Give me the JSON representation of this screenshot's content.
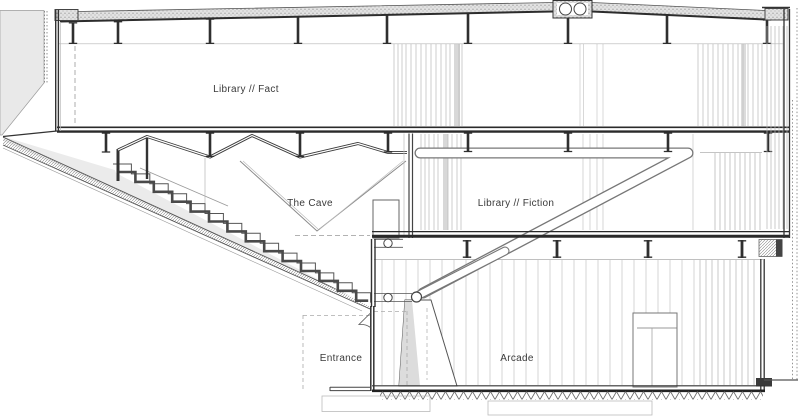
{
  "drawing": {
    "type": "architectural-section",
    "labels": {
      "fact": "Library // Fact",
      "cave": "The Cave",
      "fiction": "Library // Fiction",
      "entrance": "Entrance",
      "arcade": "Arcade"
    },
    "colors": {
      "background": "#ffffff",
      "line_dark": "#2f2f2f",
      "line_mid": "#8a8a8a",
      "line_light": "#c4c4c4",
      "terrain_fill": "#e9e9e9",
      "shade_fill": "#ebebeb",
      "text": "#3a3a3a"
    }
  }
}
